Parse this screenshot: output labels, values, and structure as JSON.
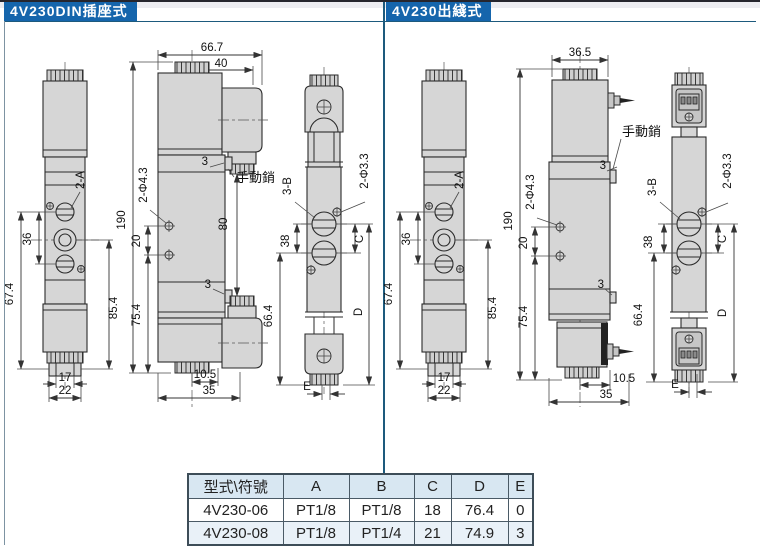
{
  "header": {
    "left": "4V230DIN插座式",
    "right": "4V230出綫式"
  },
  "colors": {
    "header_bg": "#1565ac",
    "divider": "#1d5a7d",
    "table_header_bg": "#d8e7f2",
    "table_alt_row_bg": "#e9f1f8"
  },
  "dims": {
    "l": {
      "a2": "2-A",
      "d36": "36",
      "d674": "67.4",
      "d854": "85.4",
      "d17": "17",
      "d22": "22",
      "d667": "66.7",
      "d40": "40",
      "d3a": "3",
      "manual": "手動銷",
      "d190": "190",
      "d20": "20",
      "phi43": "2-Φ4.3",
      "d754": "75.4",
      "d80": "80",
      "d3b": "3",
      "d105": "10.5",
      "d35": "35",
      "b3": "3-B",
      "d38": "38",
      "d664": "66.4",
      "phi33": "2-Φ3.3",
      "c": "C",
      "d": "D",
      "e": "E"
    },
    "r": {
      "a2": "2-A",
      "d36": "36",
      "d674": "67.4",
      "d854": "85.4",
      "d17": "17",
      "d22": "22",
      "d365": "36.5",
      "d3a": "3",
      "manual": "手動銷",
      "d190": "190",
      "d20": "20",
      "phi43": "2-Φ4.3",
      "d754": "75.4",
      "d3b": "3",
      "d105": "10.5",
      "d35": "35",
      "b3": "3-B",
      "d38": "38",
      "d664": "66.4",
      "phi33": "2-Φ3.3",
      "c": "C",
      "d": "D",
      "e": "E"
    }
  },
  "table": {
    "headers": [
      "型式\\符號",
      "A",
      "B",
      "C",
      "D",
      "E"
    ],
    "rows": [
      [
        "4V230-06",
        "PT1/8",
        "PT1/8",
        "18",
        "76.4",
        "0"
      ],
      [
        "4V230-08",
        "PT1/8",
        "PT1/4",
        "21",
        "74.9",
        "3"
      ]
    ]
  }
}
